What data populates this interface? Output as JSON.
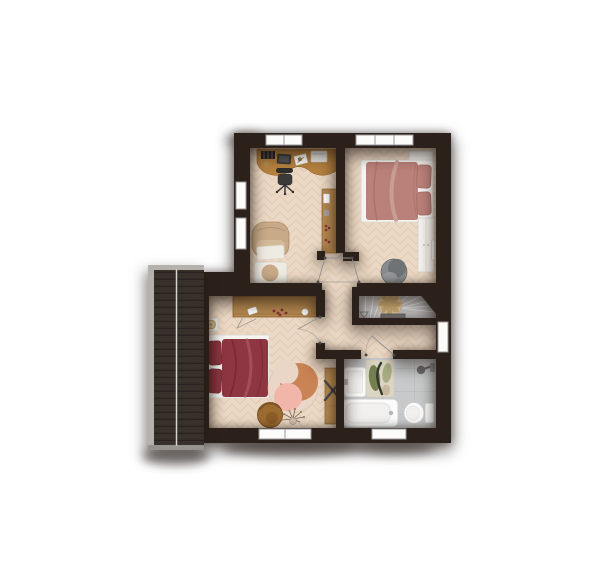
{
  "palette": {
    "wall": "#2b211a",
    "floor": "#ecd9c5",
    "floor_line": "#d8bda1",
    "bath_floor": "#c7c9ca",
    "bath_grout": "#b5b7b8",
    "roof": "#38312b",
    "roof_slat": "#282320",
    "roof_trim": "#b5b2ae",
    "roof_trim_dark": "#96938f",
    "roof_ridge": "#f2f1ef",
    "stairs": "#cccccc",
    "stair_line": "#f0f0f0",
    "stair_block": "#828282",
    "rosette": "#e9d1a5",
    "rosette_blade": "#d3ae74",
    "window": "#fbfbfa",
    "window_frame": "#999999",
    "door_line": "#8f8f8f",
    "hinge": "#4a4a4a",
    "white_furniture": "#f3f1ed",
    "furn_line": "#d4d0c8",
    "bed_white": "#f6f4f1",
    "wood": "#b5813f",
    "wood_dark": "#8d6434",
    "wood2": "#b78a50",
    "bed1": "#b98179",
    "bed1_dark": "#a1695f",
    "bed1_fold": "#caa096",
    "bed2": "#8e3641",
    "bed2_dark": "#6f2530",
    "bed2_fold": "#a5515b",
    "armchair": "#c8aa88",
    "armchair_dark": "#ab8d6b",
    "blanket": "#eeebe3",
    "chair_grey": "#898d8e",
    "chair_grey_dark": "#6f7374",
    "rug_base": "#e9d6c6",
    "rug_terracotta": "#c98355",
    "rug_pink": "#f1b6a9",
    "chair_brown": "#9c6b31",
    "chair_brown_dark": "#7c5423",
    "mat_base": "#dbd5c3",
    "mat_green": "#74814f",
    "mat_sage": "#a9ad84",
    "mat_dark": "#343930",
    "mat_tan": "#c8b89e",
    "fixture": "#fbfbfb",
    "fixture_inner": "#f1f0ee",
    "fixture_line": "#cccccc",
    "metal": "#6e6e6e",
    "black_item": "#242424",
    "laptop": "#3c3c3a",
    "paper": "#ffffff",
    "leaf": "#7b8b50",
    "berry": "#8c2f3a",
    "office_chair": "#2e2e2e",
    "twig": "#776350",
    "vase": "#cfc0ab",
    "lamp": "#dbc69c",
    "lamp_ring": "#b89b66"
  },
  "plan": {
    "type": "floor-plan",
    "rooms": [
      {
        "id": "office",
        "furniture": [
          "desk",
          "office-chair",
          "book-stack",
          "laptop",
          "paper",
          "printer",
          "armchair",
          "ottoman",
          "wall-shelf"
        ]
      },
      {
        "id": "bedroom-1",
        "furniture": [
          "double-bed",
          "pillows",
          "nightstand",
          "wardrobe",
          "wall-mirror",
          "lounge-chair"
        ]
      },
      {
        "id": "bedroom-2",
        "furniture": [
          "double-bed",
          "pillows",
          "nightstand",
          "table-lamp",
          "sideboard",
          "round-rug",
          "lounge-chair",
          "dried-bouquet",
          "dresser",
          "drying-rack"
        ]
      },
      {
        "id": "bathroom",
        "furniture": [
          "sink",
          "bath-mat",
          "bathtub",
          "toilet",
          "shower-head"
        ]
      },
      {
        "id": "hallway",
        "furniture": []
      },
      {
        "id": "staircase",
        "furniture": [
          "winder-stairs",
          "landing-block"
        ]
      },
      {
        "id": "roof-section",
        "furniture": []
      }
    ],
    "window_count": 7,
    "door_count": 4
  }
}
